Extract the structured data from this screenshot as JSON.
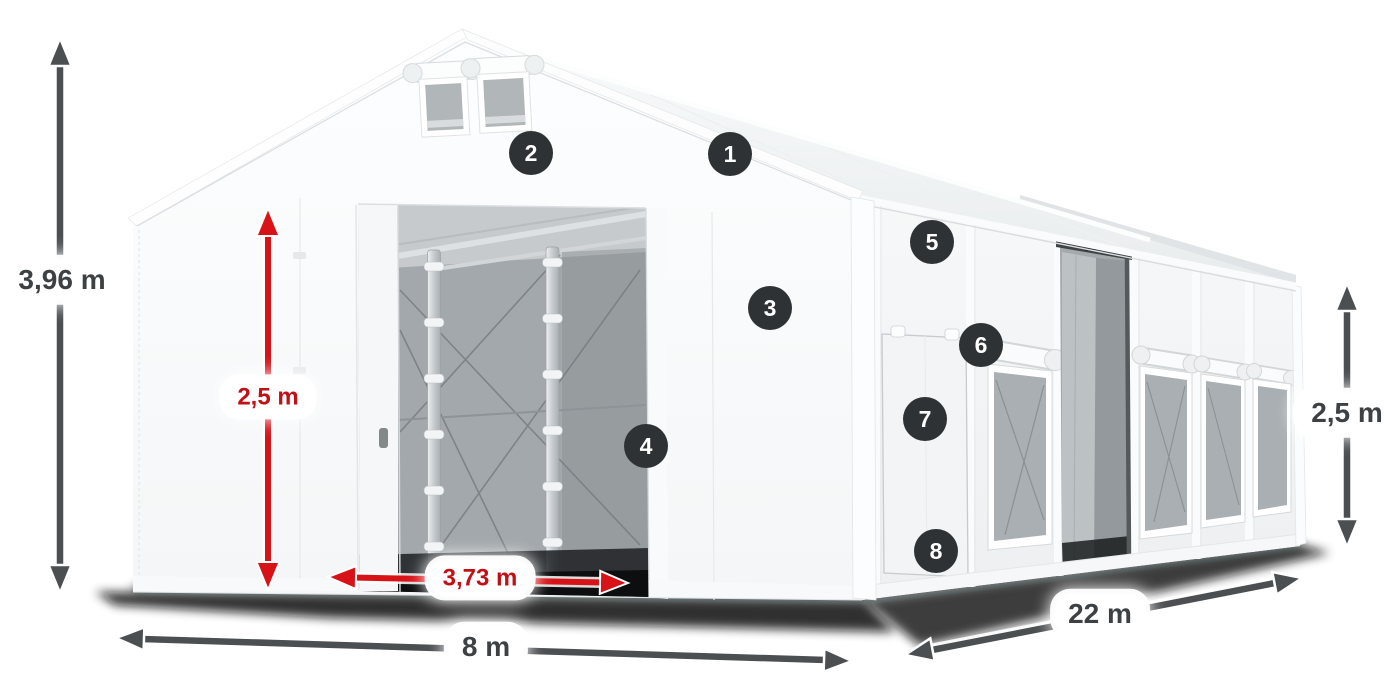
{
  "diagram": {
    "type": "product-dimension-diagram",
    "subject": "storage-tent"
  },
  "dimensions": {
    "total_height": "3,96 m",
    "entrance_height": "2,5 m",
    "entrance_width": "3,73 m",
    "front_width": "8 m",
    "side_length": "22 m",
    "side_height": "2,5 m"
  },
  "markers": [
    {
      "label": "1"
    },
    {
      "label": "2"
    },
    {
      "label": "3"
    },
    {
      "label": "4"
    },
    {
      "label": "5"
    },
    {
      "label": "6"
    },
    {
      "label": "7"
    },
    {
      "label": "8"
    }
  ],
  "colors": {
    "accent_red": "#d81318",
    "red_text": "#c11016",
    "dark_text": "#3d4144",
    "arrow_dark": "#4b4f52",
    "marker_bg": "#2f3234",
    "mesh_gray": "#a9aeb1",
    "tent_white": "#f5f7f8"
  }
}
